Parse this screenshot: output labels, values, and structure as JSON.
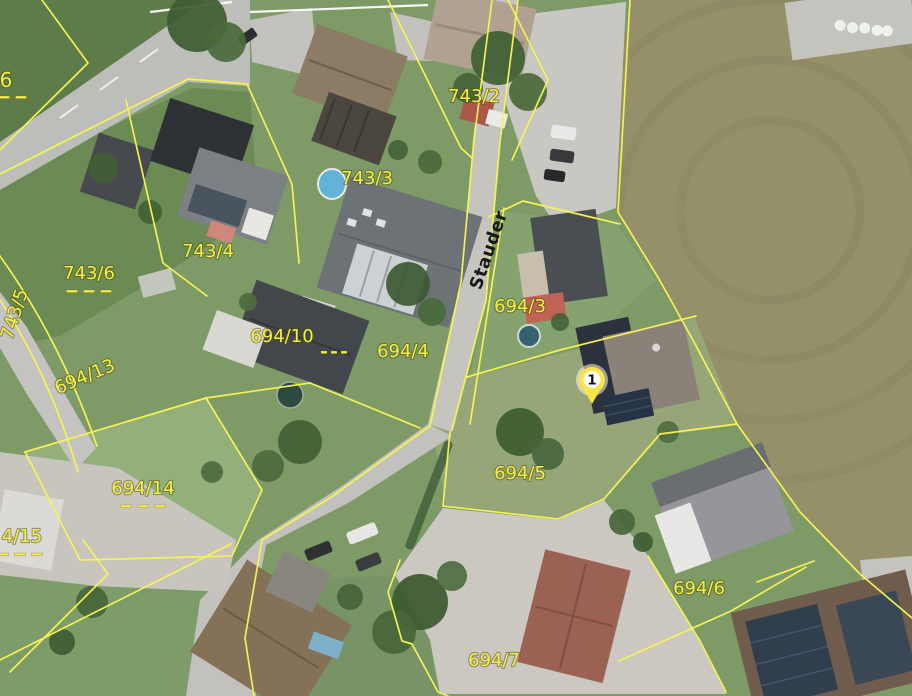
{
  "map": {
    "kind": "aerial-cadastral-map",
    "street": {
      "name": "Stauder",
      "x": 494,
      "y": 252,
      "rot": -71
    },
    "marker": {
      "number": "1",
      "x": 592,
      "y": 380
    },
    "parcel_labels": [
      {
        "text": "6",
        "x": 6,
        "y": 87,
        "size": 20,
        "dash": {
          "dx": -2,
          "dy": 9
        }
      },
      {
        "text": "743/2",
        "x": 474,
        "y": 102
      },
      {
        "text": "743/3",
        "x": 367,
        "y": 184
      },
      {
        "text": "743/4",
        "x": 208,
        "y": 257
      },
      {
        "text": "743/6",
        "x": 89,
        "y": 279,
        "dash": {
          "dx": 0,
          "dy": 11
        }
      },
      {
        "text": "743/5",
        "x": 20,
        "y": 316,
        "rot": -72
      },
      {
        "text": "694/13",
        "x": 87,
        "y": 382,
        "rot": -23
      },
      {
        "text": "694/14",
        "x": 143,
        "y": 494,
        "dash": {
          "dx": 0,
          "dy": 11
        }
      },
      {
        "text": "4/15",
        "x": 22,
        "y": 542,
        "dash": {
          "dx": -2,
          "dy": 11
        }
      },
      {
        "text": "694/10",
        "x": 282,
        "y": 342,
        "dash": {
          "dx": 52,
          "dy": 9,
          "w": 6,
          "pitch": 10
        }
      },
      {
        "text": "694/4",
        "x": 403,
        "y": 357
      },
      {
        "text": "694/3",
        "x": 520,
        "y": 312
      },
      {
        "text": "694/5",
        "x": 520,
        "y": 479
      },
      {
        "text": "694/6",
        "x": 699,
        "y": 594
      },
      {
        "text": "694/7",
        "x": 494,
        "y": 666
      }
    ],
    "colors": {
      "parcel_line": "#f7f554",
      "parcel_label": "#f2ee4b",
      "street_text": "#181818",
      "marker_yellow": "#fbe545",
      "marker_center": "#ffffff"
    }
  }
}
